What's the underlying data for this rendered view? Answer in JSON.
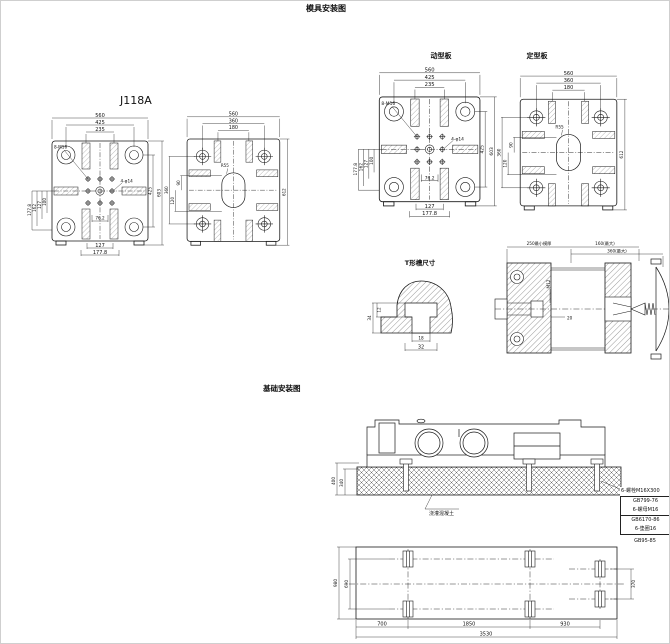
{
  "titles": {
    "main": "模具安装图",
    "model": "J118A",
    "moving_platen": "动型板",
    "fixed_platen": "定型板",
    "tslot": "T形槽尺寸",
    "foundation": "基础安装图"
  },
  "moving_platen": {
    "dims": {
      "w560": "560",
      "w425": "425",
      "w235": "235",
      "l177_8": "177.8",
      "l162": "162",
      "l127": "127",
      "l100": "100",
      "r425": "425",
      "r603": "603",
      "b76_2": "76.2",
      "b127": "127",
      "b177_8": "177.8"
    },
    "callouts": {
      "tap": "8-M16",
      "hole": "4-φ14"
    }
  },
  "fixed_platen": {
    "dims": {
      "w560": "560",
      "w360": "360",
      "w180": "180",
      "l360": "360",
      "l90": "90",
      "l120": "120",
      "r612": "612"
    },
    "callouts": {
      "radius": "R55"
    }
  },
  "tslot": {
    "dims": {
      "d34": "34",
      "d12": "12",
      "d18": "18",
      "d32": "32"
    }
  },
  "section_view": {
    "dims": {
      "min_mold": "250最小模厚",
      "max160": "160(最大)",
      "max360": "360(最大)",
      "d20": "20"
    },
    "callouts": {
      "m12": "M12"
    }
  },
  "foundation_side": {
    "dims": {
      "d400": "400",
      "d340": "340"
    },
    "note": "浇灌混凝土"
  },
  "bolt_table": {
    "leader": "6-螺栓M16X300",
    "rows": [
      "GB799-76",
      "6-螺母M16",
      "GB6170-86",
      "6-垫圈16",
      "GB95-85"
    ]
  },
  "foundation_plan": {
    "dims": {
      "d980": "980",
      "d690": "690",
      "d370": "370",
      "d700": "700",
      "d1850": "1850",
      "d930": "930",
      "d3530": "3530"
    }
  }
}
